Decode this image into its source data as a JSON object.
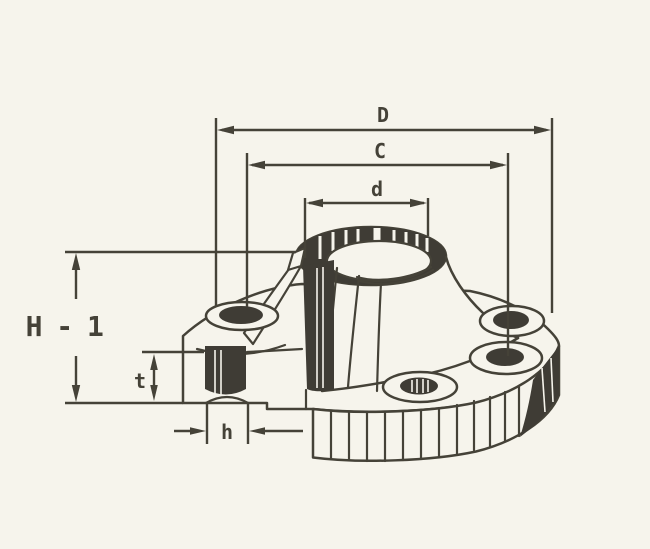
{
  "colors": {
    "paper": "#f6f4ec",
    "ink": "#454238",
    "dark_fill": "#3f3c35"
  },
  "labels": {
    "D": "D",
    "C": "C",
    "d": "d",
    "H1": "H - 1",
    "t": "t",
    "h": "h"
  }
}
